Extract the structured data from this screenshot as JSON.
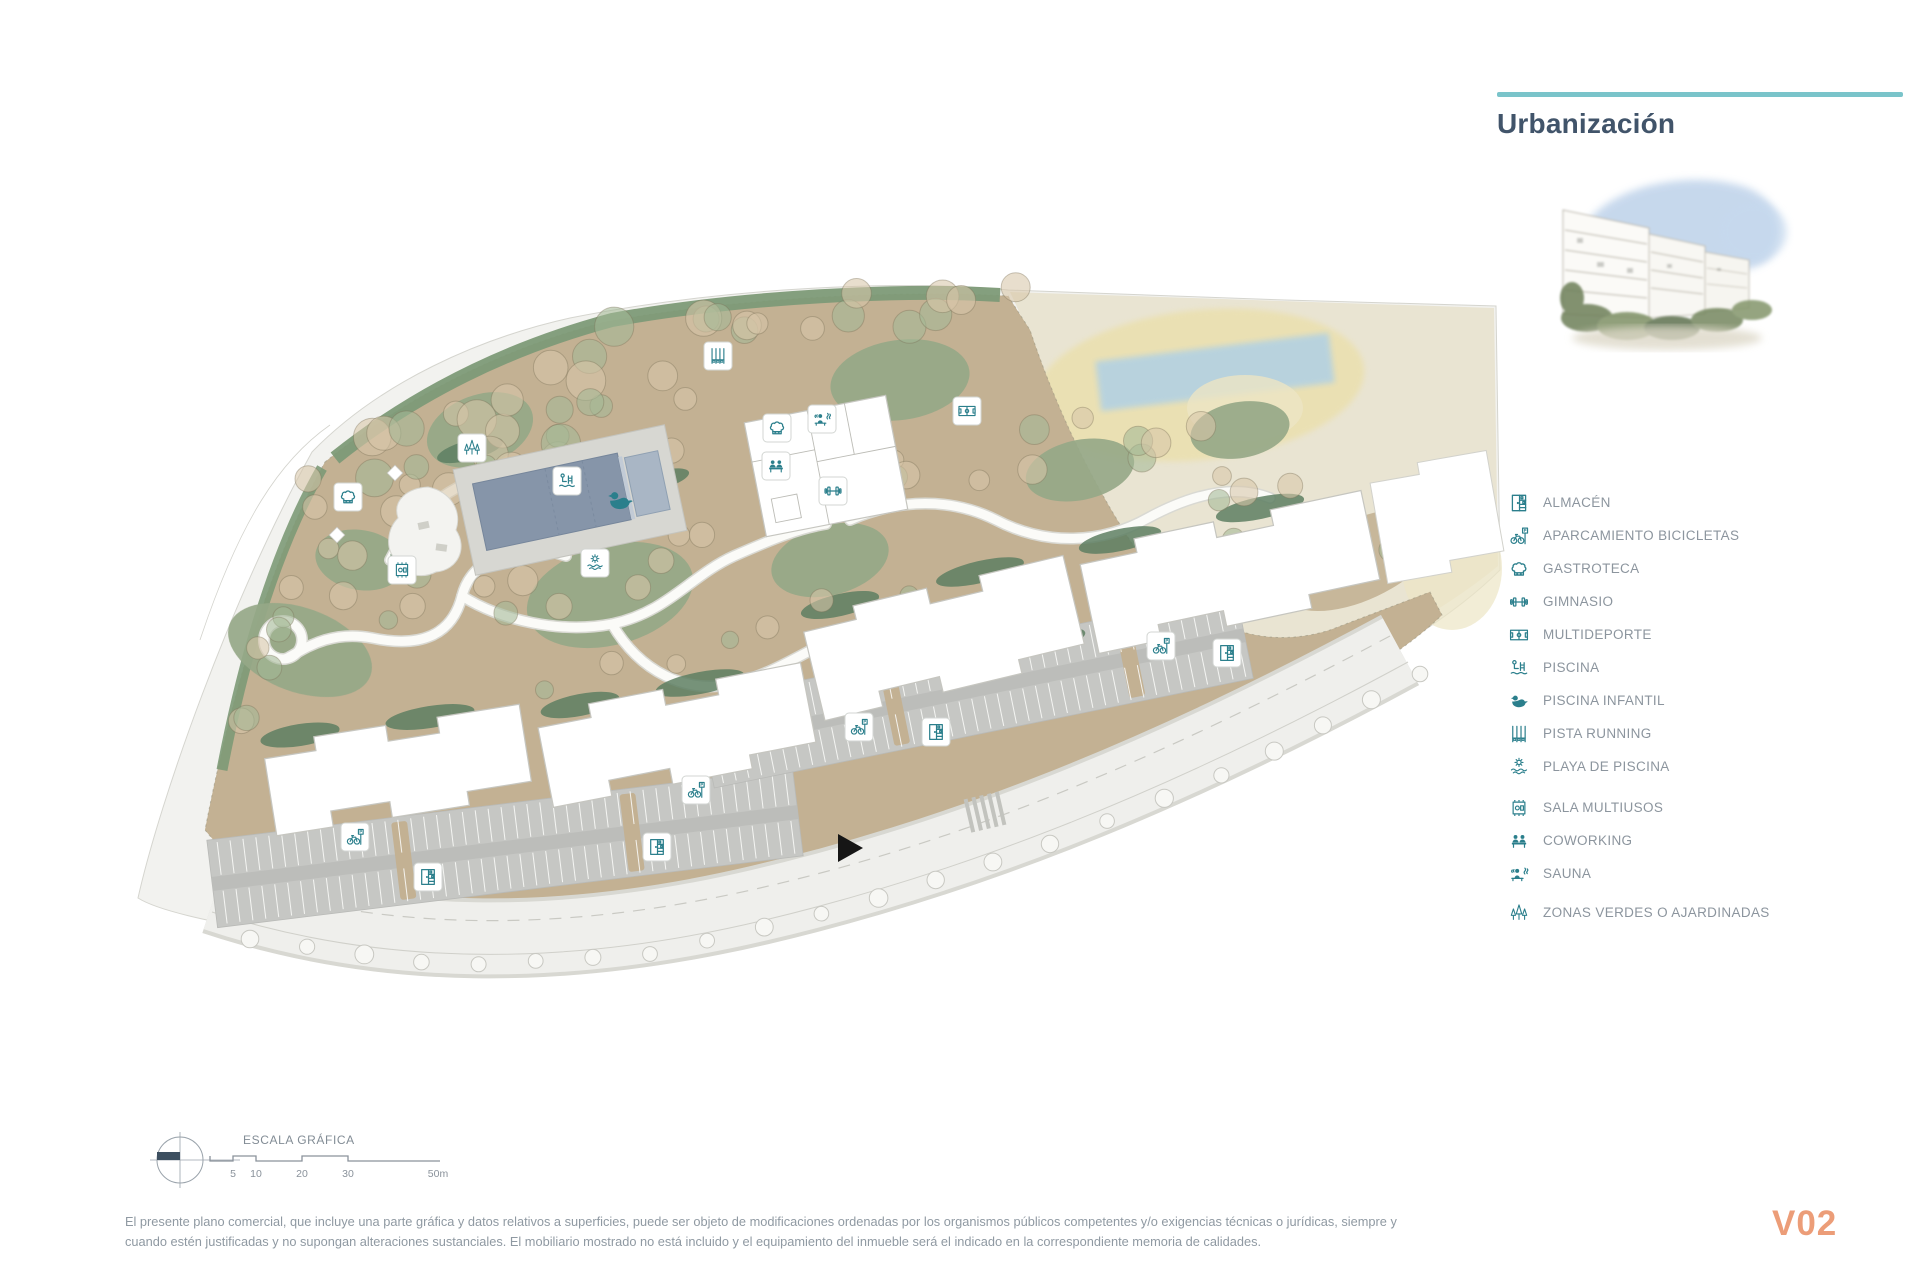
{
  "header": {
    "title": "Urbanización"
  },
  "legend": {
    "items": [
      {
        "icon": "almacen",
        "label": "ALMACÉN"
      },
      {
        "icon": "bicicletas",
        "label": "APARCAMIENTO BICICLETAS"
      },
      {
        "icon": "gastroteca",
        "label": "GASTROTECA"
      },
      {
        "icon": "gimnasio",
        "label": "GIMNASIO"
      },
      {
        "icon": "multideporte",
        "label": "MULTIDEPORTE"
      },
      {
        "icon": "piscina",
        "label": "PISCINA"
      },
      {
        "icon": "piscina-infantil",
        "label": "PISCINA INFANTIL"
      },
      {
        "icon": "pista-running",
        "label": "PISTA RUNNING"
      },
      {
        "icon": "playa-piscina",
        "label": "PLAYA DE PISCINA"
      },
      {
        "icon": "sala-multiusos",
        "label": "SALA MULTIUSOS"
      },
      {
        "icon": "coworking",
        "label": "COWORKING"
      },
      {
        "icon": "sauna",
        "label": "SAUNA"
      },
      {
        "icon": "zonas-verdes",
        "label": "ZONAS VERDES O AJARDINADAS"
      }
    ]
  },
  "map": {
    "markers": [
      {
        "icon": "gastroteca",
        "x": 348,
        "y": 497
      },
      {
        "icon": "zonas-verdes",
        "x": 472,
        "y": 448
      },
      {
        "icon": "sala-multiusos",
        "x": 402,
        "y": 570
      },
      {
        "icon": "pista-running",
        "x": 718,
        "y": 356
      },
      {
        "icon": "piscina",
        "x": 567,
        "y": 481
      },
      {
        "icon": "piscina-infantil",
        "x": 620,
        "y": 500,
        "boxed": false
      },
      {
        "icon": "playa-piscina",
        "x": 595,
        "y": 563
      },
      {
        "icon": "gastroteca",
        "x": 777,
        "y": 428
      },
      {
        "icon": "sauna",
        "x": 822,
        "y": 419
      },
      {
        "icon": "coworking",
        "x": 776,
        "y": 466
      },
      {
        "icon": "gimnasio",
        "x": 833,
        "y": 491
      },
      {
        "icon": "multideporte",
        "x": 967,
        "y": 411
      },
      {
        "icon": "bicicletas",
        "x": 859,
        "y": 727
      },
      {
        "icon": "almacen",
        "x": 936,
        "y": 732
      },
      {
        "icon": "bicicletas",
        "x": 696,
        "y": 790
      },
      {
        "icon": "almacen",
        "x": 657,
        "y": 847
      },
      {
        "icon": "bicicletas",
        "x": 355,
        "y": 837
      },
      {
        "icon": "almacen",
        "x": 428,
        "y": 877
      },
      {
        "icon": "bicicletas",
        "x": 1161,
        "y": 646
      },
      {
        "icon": "almacen",
        "x": 1227,
        "y": 653
      }
    ]
  },
  "scale_bar": {
    "title": "ESCALA GRÁFICA",
    "ticks": [
      {
        "label": "5",
        "x": 233
      },
      {
        "label": "10",
        "x": 256
      },
      {
        "label": "20",
        "x": 302
      },
      {
        "label": "30",
        "x": 348
      },
      {
        "label": "50m",
        "x": 438
      }
    ]
  },
  "footer": {
    "disclaimer_line1": "El presente plano comercial, que incluye una parte gráfica y datos relativos a superficies, puede ser objeto de modificaciones ordenadas por los organismos públicos competentes y/o exigencias técnicas o jurídicas, siempre y",
    "disclaimer_line2": "cuando estén justificadas y no supongan alteraciones sustanciales. El mobiliario mostrado no está incluido y el equipamiento del inmueble será el indicado en la correspondiente memoria de calidades.",
    "version": "V02"
  },
  "colors": {
    "accent_teal": "#7ac4ca",
    "icon_teal": "#2b7f8c",
    "title_color": "#41546a",
    "version_color": "#ec9d78",
    "tan": "#c3b193",
    "green": "#96a888",
    "pool_water": "#8695a9"
  }
}
